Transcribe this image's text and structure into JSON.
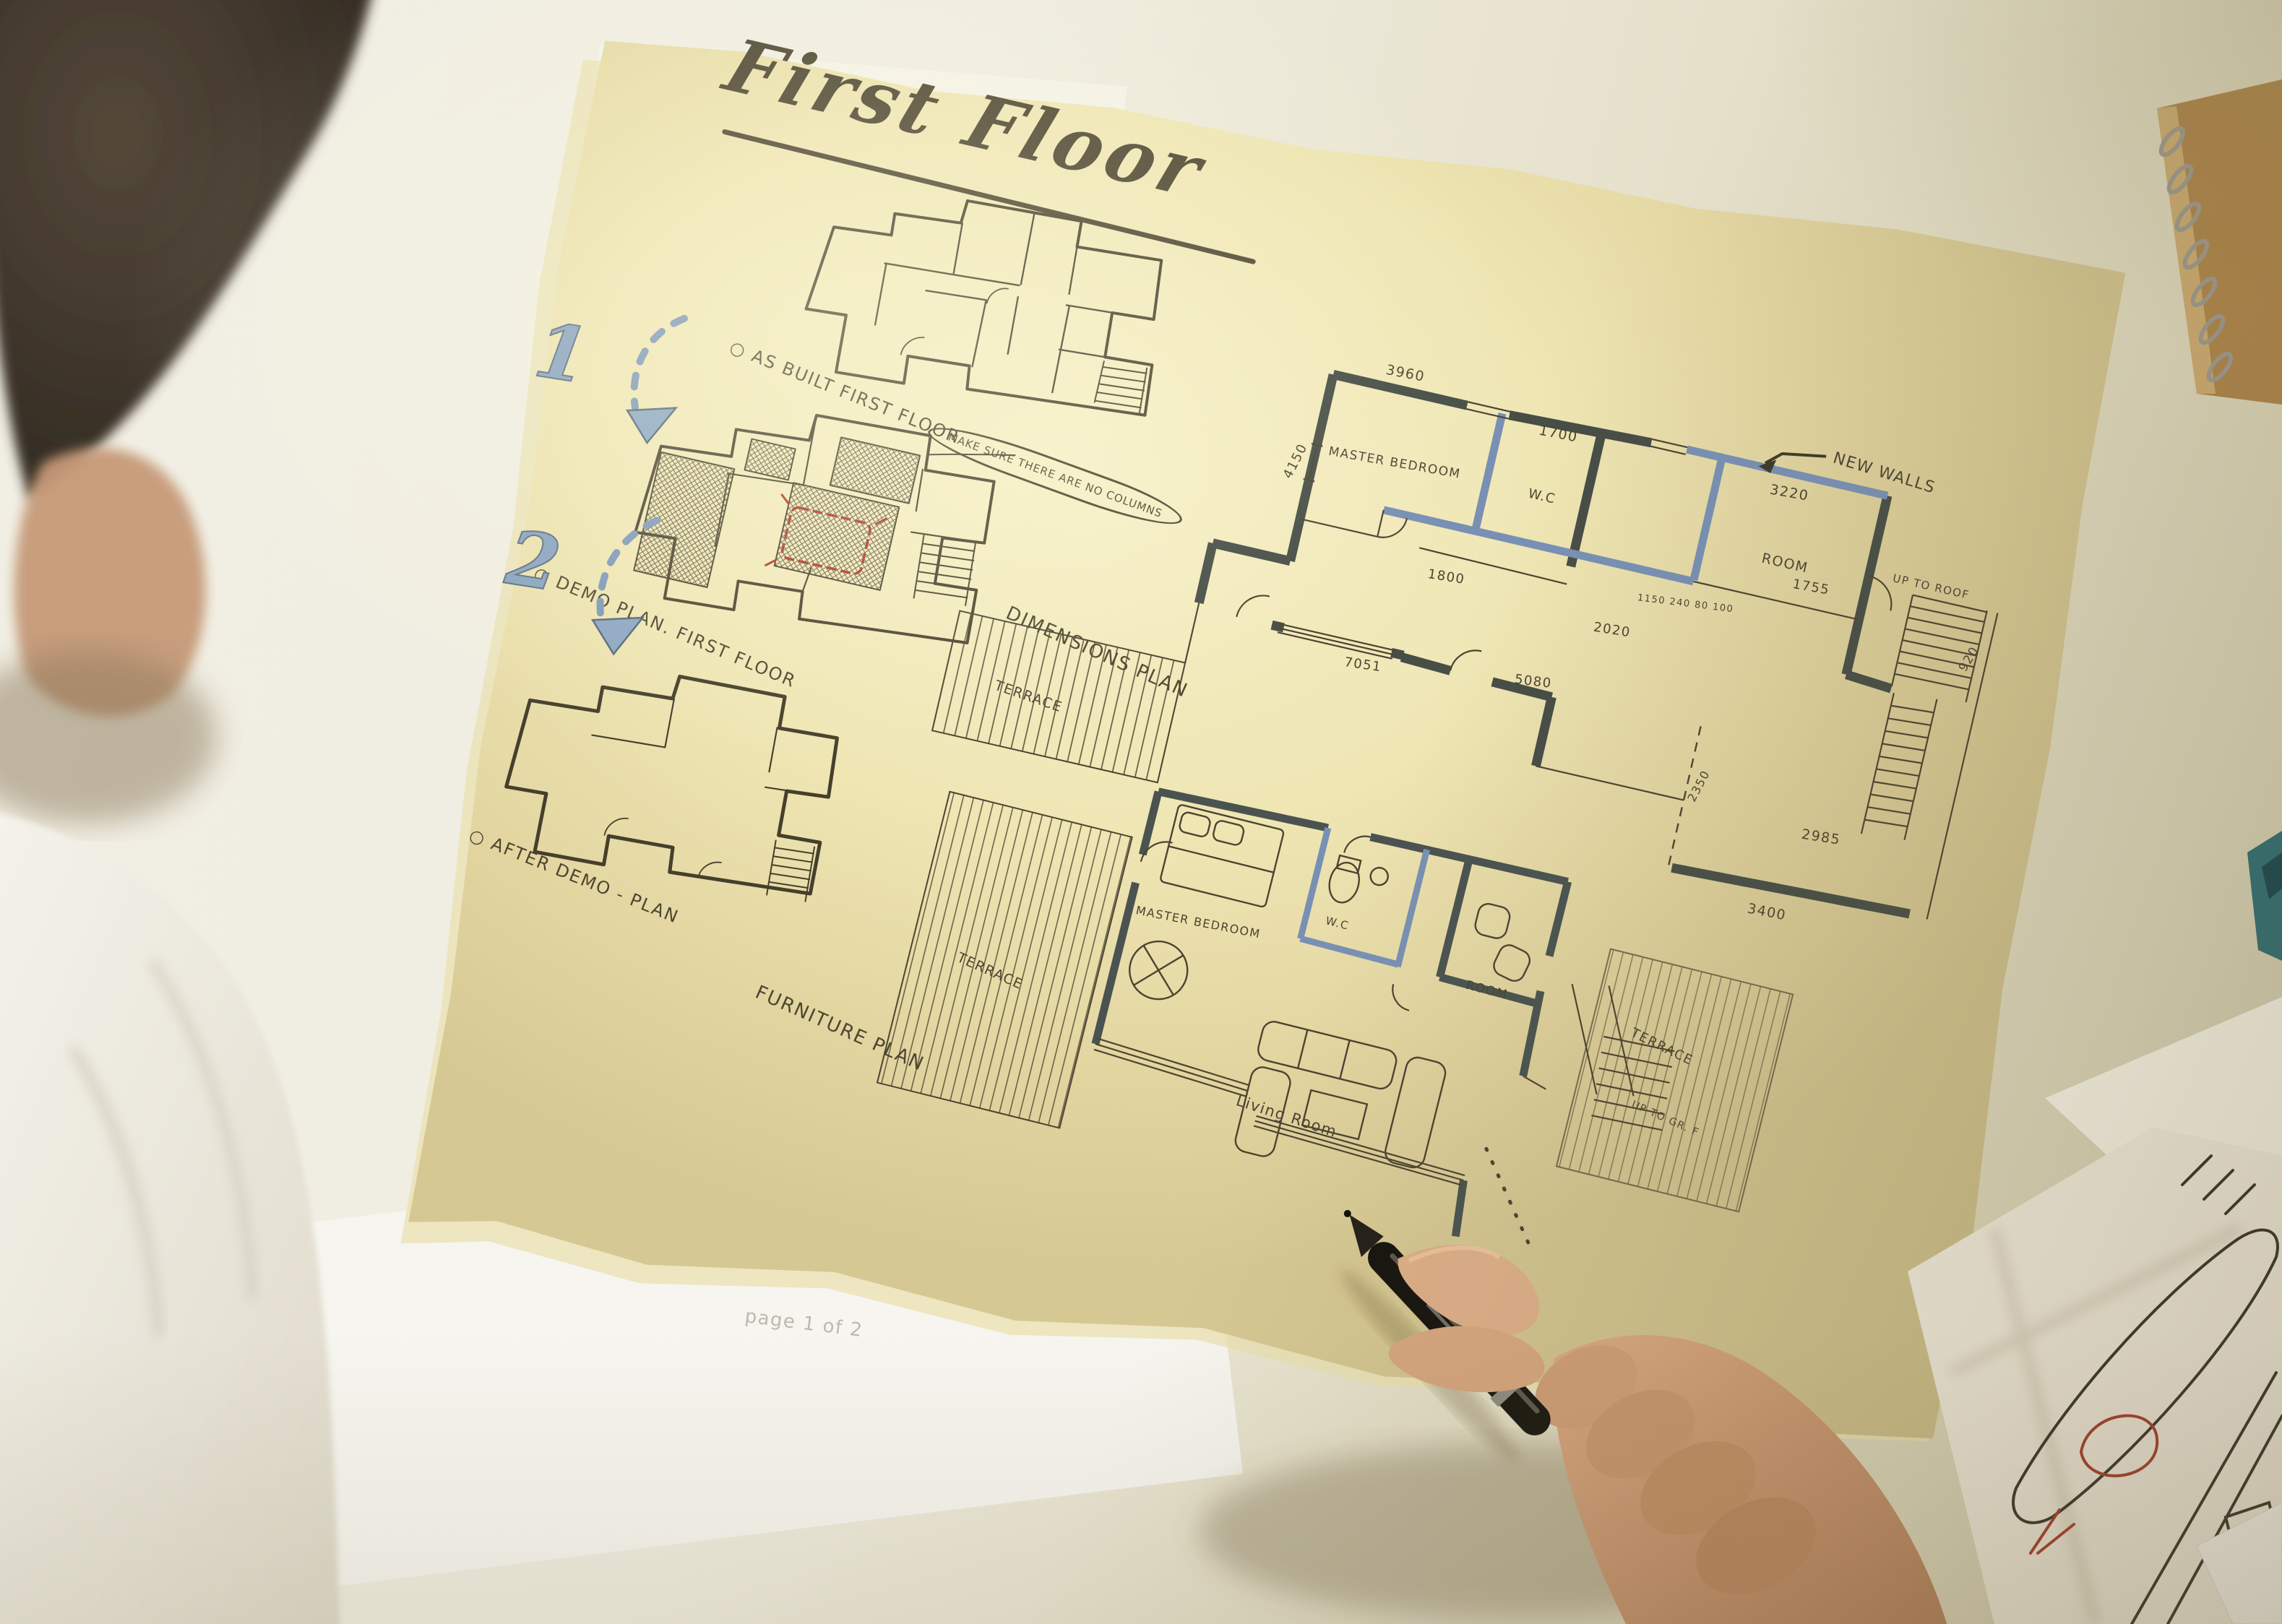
{
  "sheet": {
    "title": "First Floor",
    "markers": {
      "one": "1",
      "two": "2"
    },
    "as_built": {
      "label": "○ AS BUILT FIRST FLOOR"
    },
    "demo": {
      "label": "○ DEMO PLAN. FIRST FLOOR",
      "note": "MAKE SURE THERE ARE NO COLUMNS"
    },
    "after_demo": {
      "label": "○ AFTER DEMO - PLAN"
    },
    "dimensions": {
      "label": "DIMENSIONS PLAN",
      "new_walls": "NEW WALLS",
      "terrace": "TERRACE",
      "stairs_note": "UP TO ROOF",
      "rooms": {
        "master": "MASTER BEDROOM",
        "wc": "W.C",
        "room": "ROOM"
      },
      "dims": {
        "d3960": "3960",
        "d1700": "1700",
        "d3220": "3220",
        "d1755": "1755",
        "d4150": "4150",
        "d1800": "1800",
        "d2020": "2020",
        "chain": "1150 240 80 100",
        "d5080": "5080",
        "d7051": "7051",
        "d920": "920",
        "d2985": "2985",
        "d2350": "2350",
        "d3400": "3400"
      }
    },
    "furniture": {
      "label": "FURNITURE PLAN",
      "terrace_left": "TERRACE",
      "terrace_right": "TERRACE",
      "stairs_note": "UP TO GR. F",
      "rooms": {
        "master": "MASTER BEDROOM",
        "wc": "W.C",
        "room": "ROOM",
        "living": "Living Room"
      }
    }
  },
  "underlay": {
    "page_note": "page 1 of 2"
  },
  "colors": {
    "ink": "#4c4431",
    "new_wall_blue": "#7890b4",
    "marker_blue": "#87a3c0",
    "red": "#ad3a28",
    "paper": "#efe6b4"
  }
}
